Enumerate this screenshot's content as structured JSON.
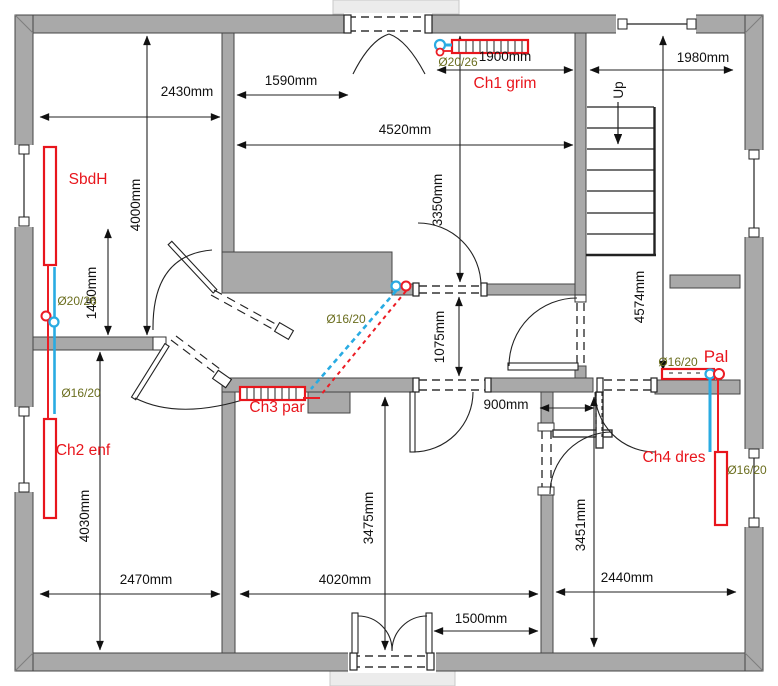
{
  "plan_type": "floor-plan",
  "colors": {
    "wall": "#a9a9a9",
    "radiator_red": "#e8151c",
    "pipe_blue": "#29abe2",
    "pipe_red": "#ec1c24",
    "spec_green": "#6b6e1f",
    "dimension_text": "#111111"
  },
  "dimensions": {
    "d2430": "2430mm",
    "d1590": "1590mm",
    "d1900": "1900mm",
    "d1980": "1980mm",
    "d4520": "4520mm",
    "d3350": "3350mm",
    "d4000": "4000mm",
    "d1450": "1450mm",
    "d1075": "1075mm",
    "d900": "900mm",
    "d4030": "4030mm",
    "d2470": "2470mm",
    "d3475": "3475mm",
    "d4020": "4020mm",
    "d1500": "1500mm",
    "d3451": "3451mm",
    "d2440": "2440mm",
    "d4574": "4574mm"
  },
  "radiators": {
    "sbdh": {
      "label": "SbdH",
      "spec": "Ø20/26"
    },
    "ch1": {
      "label": "Ch1 grim",
      "spec": "Ø20/26"
    },
    "ch2": {
      "label": "Ch2 enf",
      "spec": "Ø16/20"
    },
    "ch3": {
      "label": "Ch3 par",
      "spec": "Ø16/20"
    },
    "ch4": {
      "label": "Ch4 dres",
      "spec": "Ø16/20"
    },
    "pal": {
      "label": "Pal",
      "spec": "Ø16/20"
    }
  },
  "stairs": {
    "direction_label": "Up"
  }
}
